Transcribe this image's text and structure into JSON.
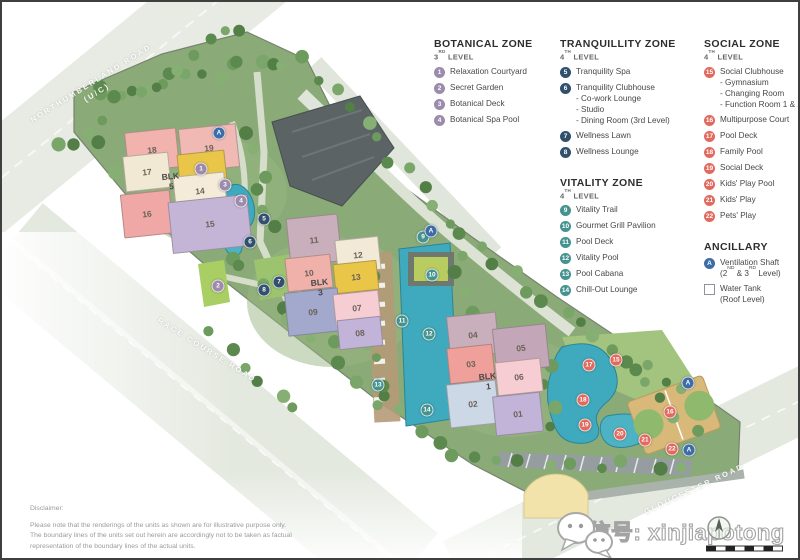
{
  "legend": {
    "columns": [
      [
        {
          "id": "botanical",
          "title": "BOTANICAL ZONE",
          "level": "3RD LEVEL",
          "color": "#9c8bab",
          "items": [
            {
              "num": "1",
              "label": "Relaxation Courtyard"
            },
            {
              "num": "2",
              "label": "Secret Garden"
            },
            {
              "num": "3",
              "label": "Botanical Deck"
            },
            {
              "num": "4",
              "label": "Botanical Spa Pool"
            }
          ]
        }
      ],
      [
        {
          "id": "tranquillity",
          "title": "TRANQUILLITY ZONE",
          "level": "4TH LEVEL",
          "color": "#31506c",
          "items": [
            {
              "num": "5",
              "label": "Tranquility Spa"
            },
            {
              "num": "6",
              "label": "Tranquility Clubhouse",
              "subs": [
                "- Co-work Lounge",
                "- Studio",
                "- Dining Room (3rd Level)"
              ]
            },
            {
              "num": "7",
              "label": "Wellness Lawn"
            },
            {
              "num": "8",
              "label": "Wellness Lounge"
            }
          ]
        },
        {
          "id": "vitality",
          "title": "VITALITY ZONE",
          "level": "4TH LEVEL",
          "color": "#45938e",
          "items": [
            {
              "num": "9",
              "label": "Vitality Trail"
            },
            {
              "num": "10",
              "label": "Gourmet Grill Pavilion"
            },
            {
              "num": "11",
              "label": "Pool Deck"
            },
            {
              "num": "12",
              "label": "Vitality Pool"
            },
            {
              "num": "13",
              "label": "Pool Cabana"
            },
            {
              "num": "14",
              "label": "Chill-Out Lounge"
            }
          ]
        }
      ],
      [
        {
          "id": "social",
          "title": "SOCIAL ZONE",
          "level": "4TH LEVEL",
          "color": "#e16a5e",
          "items": [
            {
              "num": "15",
              "label": "Social Clubhouse",
              "subs": [
                "- Gymnasium",
                "- Changing Room",
                "- Function Room 1 & 2"
              ]
            },
            {
              "num": "16",
              "label": "Multipurpose Court"
            },
            {
              "num": "17",
              "label": "Pool Deck"
            },
            {
              "num": "18",
              "label": "Family Pool"
            },
            {
              "num": "19",
              "label": "Social Deck"
            },
            {
              "num": "20",
              "label": "Kids' Play Pool"
            },
            {
              "num": "21",
              "label": "Kids' Play"
            },
            {
              "num": "22",
              "label": "Pets' Play"
            }
          ]
        },
        {
          "id": "ancillary",
          "title": "ANCILLARY",
          "level": "",
          "color": "#3e6ca6",
          "items": [
            {
              "num": "A",
              "label": "Ventilation Shaft",
              "subs": [
                "(2ND & 3RD Level)"
              ]
            },
            {
              "square": true,
              "label": "Water Tank",
              "subs": [
                "(Roof Level)"
              ]
            }
          ]
        }
      ]
    ]
  },
  "map": {
    "marker_colors": {
      "botanical": "#9c8bab",
      "tranquillity": "#31506c",
      "vitality": "#45938e",
      "social": "#e16a5e",
      "ancillary": "#3e6ca6"
    },
    "roads": [
      {
        "text": "NORTHUMBERLAND ROAD",
        "sub": "(U/C)",
        "x": 92,
        "y": 86,
        "rot": -32
      },
      {
        "text": "RACE COURSE ROAD",
        "sub": "",
        "x": 205,
        "y": 348,
        "rot": 32
      },
      {
        "text": "GLOUCESTER ROAD",
        "sub": "",
        "x": 692,
        "y": 487,
        "rot": -25
      }
    ],
    "blocks": [
      {
        "word": "BLK",
        "num": "5",
        "x": 169,
        "y": 180
      },
      {
        "word": "BLK",
        "num": "3",
        "x": 318,
        "y": 286
      },
      {
        "word": "BLK",
        "num": "1",
        "x": 486,
        "y": 380
      }
    ],
    "buildings": [
      {
        "label": "18",
        "x": 124,
        "y": 128,
        "w": 50,
        "h": 38,
        "color": "#f2b3ae"
      },
      {
        "label": "19",
        "x": 178,
        "y": 124,
        "w": 56,
        "h": 42,
        "color": "#f0b9b3"
      },
      {
        "label": "17",
        "x": 122,
        "y": 152,
        "w": 44,
        "h": 34,
        "color": "#f2e9d4"
      },
      {
        "label": "20",
        "x": 176,
        "y": 150,
        "w": 46,
        "h": 30,
        "color": "#e9c647"
      },
      {
        "label": "16",
        "x": 120,
        "y": 190,
        "w": 48,
        "h": 42,
        "color": "#efa8a6"
      },
      {
        "label": "14",
        "x": 172,
        "y": 172,
        "w": 50,
        "h": 32,
        "color": "#f4ebd8"
      },
      {
        "label": "15",
        "x": 168,
        "y": 196,
        "w": 78,
        "h": 50,
        "color": "#c4b5d7"
      },
      {
        "label": "11",
        "x": 286,
        "y": 214,
        "w": 50,
        "h": 46,
        "color": "#c9aebc"
      },
      {
        "label": "10",
        "x": 284,
        "y": 254,
        "w": 44,
        "h": 32,
        "color": "#f0b1ab"
      },
      {
        "label": "12",
        "x": 334,
        "y": 236,
        "w": 42,
        "h": 32,
        "color": "#f2ead6"
      },
      {
        "label": "13",
        "x": 332,
        "y": 260,
        "w": 42,
        "h": 28,
        "color": "#e9c647"
      },
      {
        "label": "09",
        "x": 284,
        "y": 288,
        "w": 52,
        "h": 42,
        "color": "#a3a8cd"
      },
      {
        "label": "07",
        "x": 332,
        "y": 290,
        "w": 44,
        "h": 30,
        "color": "#f6cdd2"
      },
      {
        "label": "08",
        "x": 336,
        "y": 316,
        "w": 42,
        "h": 28,
        "color": "#c2b3d9"
      },
      {
        "label": "04",
        "x": 446,
        "y": 312,
        "w": 48,
        "h": 40,
        "color": "#c9aebc"
      },
      {
        "label": "05",
        "x": 492,
        "y": 324,
        "w": 52,
        "h": 42,
        "color": "#c3a7b8"
      },
      {
        "label": "03",
        "x": 446,
        "y": 344,
        "w": 44,
        "h": 34,
        "color": "#efa09a"
      },
      {
        "label": "06",
        "x": 494,
        "y": 358,
        "w": 44,
        "h": 32,
        "color": "#f6cdd2"
      },
      {
        "label": "02",
        "x": 446,
        "y": 380,
        "w": 48,
        "h": 42,
        "color": "#ccd8e5"
      },
      {
        "label": "01",
        "x": 492,
        "y": 392,
        "w": 46,
        "h": 38,
        "color": "#c2b3d9"
      }
    ],
    "markers": [
      {
        "n": "1",
        "zone": "botanical",
        "x": 199,
        "y": 167
      },
      {
        "n": "2",
        "zone": "botanical",
        "x": 216,
        "y": 284
      },
      {
        "n": "3",
        "zone": "botanical",
        "x": 223,
        "y": 183
      },
      {
        "n": "4",
        "zone": "botanical",
        "x": 239,
        "y": 199
      },
      {
        "n": "5",
        "zone": "tranquillity",
        "x": 262,
        "y": 217
      },
      {
        "n": "6",
        "zone": "tranquillity",
        "x": 248,
        "y": 240
      },
      {
        "n": "7",
        "zone": "tranquillity",
        "x": 277,
        "y": 280
      },
      {
        "n": "8",
        "zone": "tranquillity",
        "x": 262,
        "y": 288
      },
      {
        "n": "9",
        "zone": "vitality",
        "x": 421,
        "y": 235
      },
      {
        "n": "10",
        "zone": "vitality",
        "x": 430,
        "y": 273
      },
      {
        "n": "11",
        "zone": "vitality",
        "x": 400,
        "y": 319
      },
      {
        "n": "12",
        "zone": "vitality",
        "x": 427,
        "y": 332
      },
      {
        "n": "13",
        "zone": "vitality",
        "x": 376,
        "y": 383
      },
      {
        "n": "14",
        "zone": "vitality",
        "x": 425,
        "y": 408
      },
      {
        "n": "15",
        "zone": "social",
        "x": 614,
        "y": 358
      },
      {
        "n": "16",
        "zone": "social",
        "x": 668,
        "y": 410
      },
      {
        "n": "17",
        "zone": "social",
        "x": 587,
        "y": 363
      },
      {
        "n": "18",
        "zone": "social",
        "x": 581,
        "y": 398
      },
      {
        "n": "19",
        "zone": "social",
        "x": 583,
        "y": 423
      },
      {
        "n": "20",
        "zone": "social",
        "x": 618,
        "y": 432
      },
      {
        "n": "21",
        "zone": "social",
        "x": 643,
        "y": 438
      },
      {
        "n": "22",
        "zone": "social",
        "x": 670,
        "y": 447
      },
      {
        "n": "A",
        "zone": "ancillary",
        "x": 217,
        "y": 131
      },
      {
        "n": "A",
        "zone": "ancillary",
        "x": 429,
        "y": 229
      },
      {
        "n": "A",
        "zone": "ancillary",
        "x": 686,
        "y": 381
      },
      {
        "n": "A",
        "zone": "ancillary",
        "x": 687,
        "y": 448
      }
    ]
  },
  "disclaimer": {
    "title": "Disclaimer:",
    "lines": [
      "Please note that the renderings of the units as shown are for illustrative purpose only.",
      "The boundary lines of the units set out herein are accordingly not to be taken as factual",
      "representation of the boundary lines of the actual units."
    ]
  },
  "watermark": {
    "text": "微信号: xinjiapotong"
  }
}
